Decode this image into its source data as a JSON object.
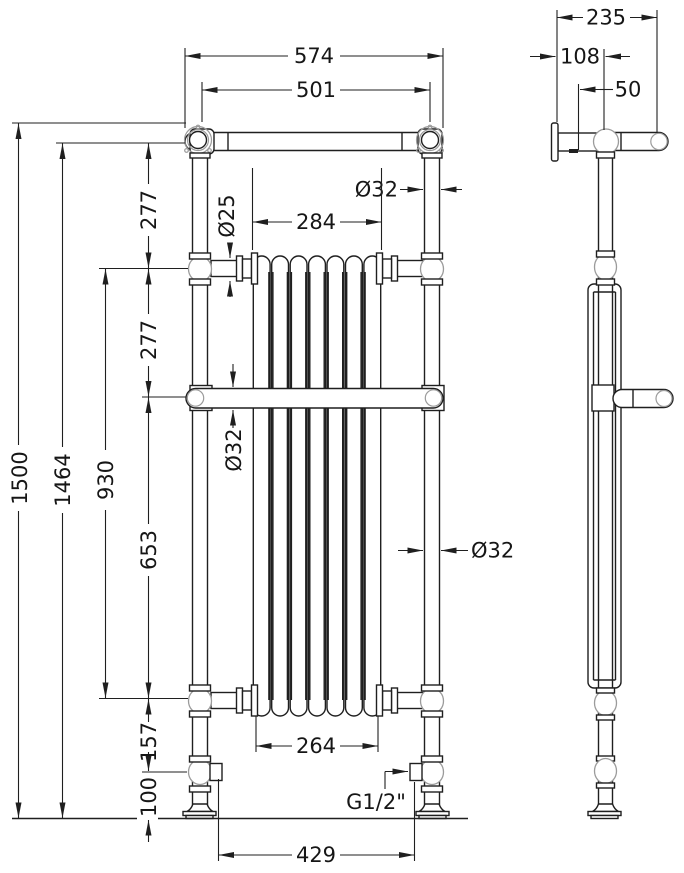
{
  "drawing": {
    "type": "technical-dimension-drawing",
    "subject": "traditional floor-standing towel radiator",
    "views": {
      "front": "front elevation",
      "side": "side elevation"
    },
    "colors": {
      "line": "#1f1f1f",
      "secondary": "#9b9b9b",
      "background": "#ffffff"
    },
    "front_dims": {
      "overall_width": "574",
      "rail_span": "501",
      "top_column_diameter": "Ø32",
      "connector_diameter": "Ø25",
      "core_width_top": "284",
      "towel_bar_diameter": "Ø32",
      "column_diameter": "Ø32",
      "overall_height": "1500",
      "height_to_rail": "1464",
      "connector_span": "930",
      "rail_to_connector": "277",
      "connector_to_bar": "277",
      "bar_to_lower_connector": "653",
      "lower_connector_to_valve": "157",
      "valve_height": "100",
      "core_width_bottom": "264",
      "valve_thread": "G1/2\"",
      "base_span": "429"
    },
    "side_dims": {
      "overall_depth": "235",
      "wall_to_column": "108",
      "column_offset": "50"
    }
  }
}
